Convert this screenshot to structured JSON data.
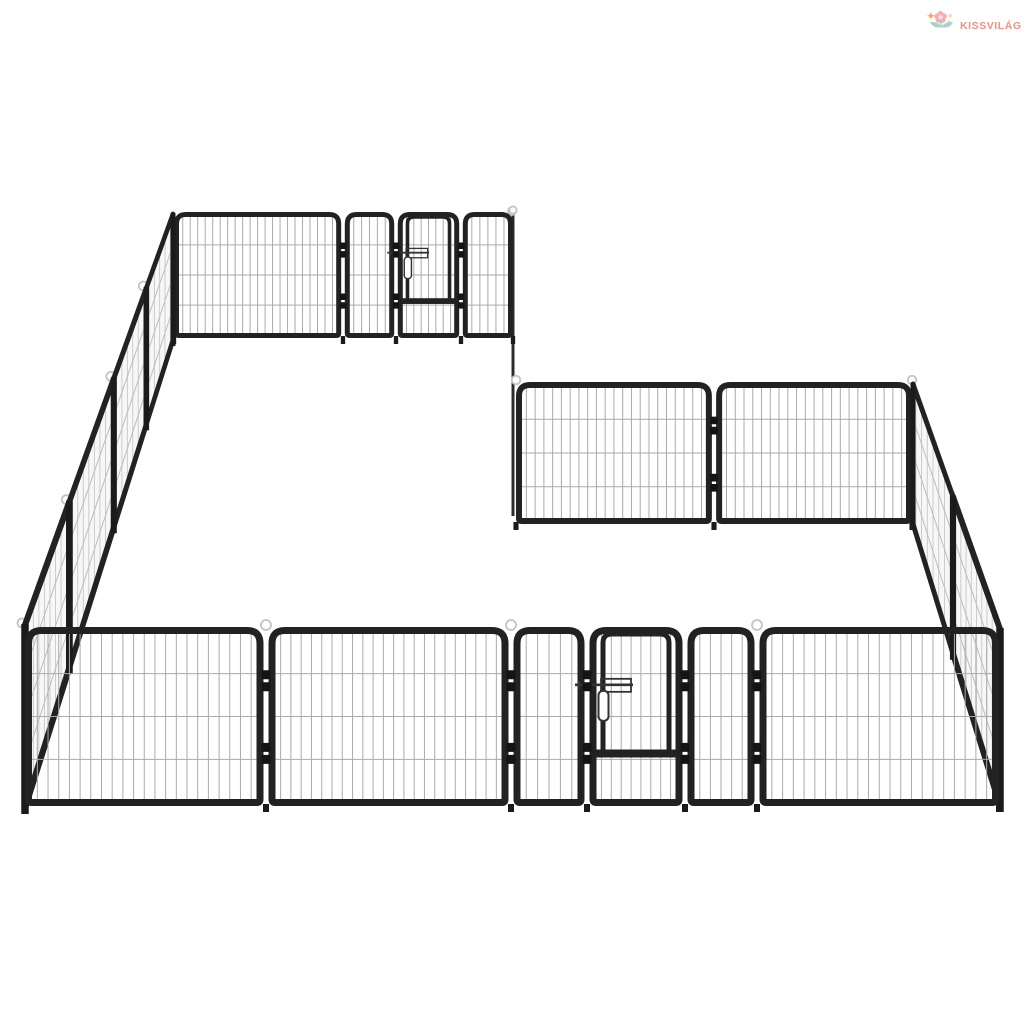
{
  "logo": {
    "brand": "KISSVILÁG",
    "icon": "flower-sprout-icon",
    "colors": {
      "text": "#f0917e",
      "petal": "#f5adb6",
      "petal_center": "#fbe7e6",
      "leaf": "#a5d6c8",
      "stem": "#8fcdbb",
      "spark_orange": "#f4a44f",
      "spark_yellow": "#f8d795"
    }
  },
  "illustration": {
    "subject": "black steel dog playpen, L-shaped arrangement of mesh panels with two latched gate doors",
    "colors": {
      "background": "#ffffff",
      "frame": "#222222",
      "post": "#1b1b1b",
      "hinge": "#141414",
      "mesh": "#aaaaaa",
      "mesh_side": "#c7c7c7",
      "side_fill": "#f7f7f7",
      "slat": "#bdbdbd",
      "loop": "#c3c3c3",
      "latch": "#333333"
    },
    "geometry": {
      "canvas": {
        "w": 1024,
        "h": 1024
      },
      "mesh": {
        "v_spacing": 10.5,
        "h_fracs": [
          0.24,
          0.5,
          0.76
        ],
        "side_v_spacing": 5.5
      },
      "connector": {
        "x": 513,
        "y_top": 213,
        "y_bottom": 516
      },
      "walls": [
        {
          "kind": "front",
          "name": "back-wall",
          "x_edges": [
            174,
            343,
            396,
            461,
            513
          ],
          "panel_types": [
            "mesh",
            "mesh",
            "gate",
            "mesh"
          ],
          "y_top": 212,
          "y_bottom": 338,
          "frame": 5,
          "scale": 0.72,
          "loops_at": [
            4
          ]
        },
        {
          "kind": "side",
          "name": "left-wall",
          "back": {
            "x": 173,
            "y_top": 214,
            "y_bottom": 340
          },
          "front": {
            "x": 25,
            "y_top": 625,
            "y_bottom": 808
          },
          "post_fracs": [
            0,
            0.18,
            0.4,
            0.7,
            1
          ],
          "loop_posts": [
            1,
            2,
            3,
            4
          ]
        },
        {
          "kind": "front",
          "name": "middle-back-wall",
          "x_edges": [
            516,
            714,
            912
          ],
          "panel_types": [
            "mesh",
            "mesh"
          ],
          "y_top": 382,
          "y_bottom": 524,
          "frame": 6,
          "scale": 0.85,
          "loops_at": [
            0,
            2
          ]
        },
        {
          "kind": "side",
          "name": "right-wall",
          "back": {
            "x": 913,
            "y_top": 384,
            "y_bottom": 524
          },
          "front": {
            "x": 1000,
            "y_top": 629,
            "y_bottom": 806
          },
          "post_fracs": [
            0,
            0.46,
            1
          ],
          "loop_posts": [
            1
          ]
        },
        {
          "kind": "front",
          "name": "front-wall",
          "x_edges": [
            25,
            266,
            511,
            587,
            685,
            757,
            999
          ],
          "panel_types": [
            "mesh",
            "mesh",
            "mesh",
            "gate",
            "mesh",
            "mesh"
          ],
          "y_top": 627,
          "y_bottom": 806,
          "frame": 7,
          "scale": 1.0,
          "loops_at": [
            1,
            2,
            5
          ]
        }
      ],
      "gate": {
        "door_margin": 4,
        "rail_frac": 0.7,
        "latch_frac": 0.44
      },
      "hinge_fracs": [
        0.22,
        0.66
      ]
    }
  }
}
